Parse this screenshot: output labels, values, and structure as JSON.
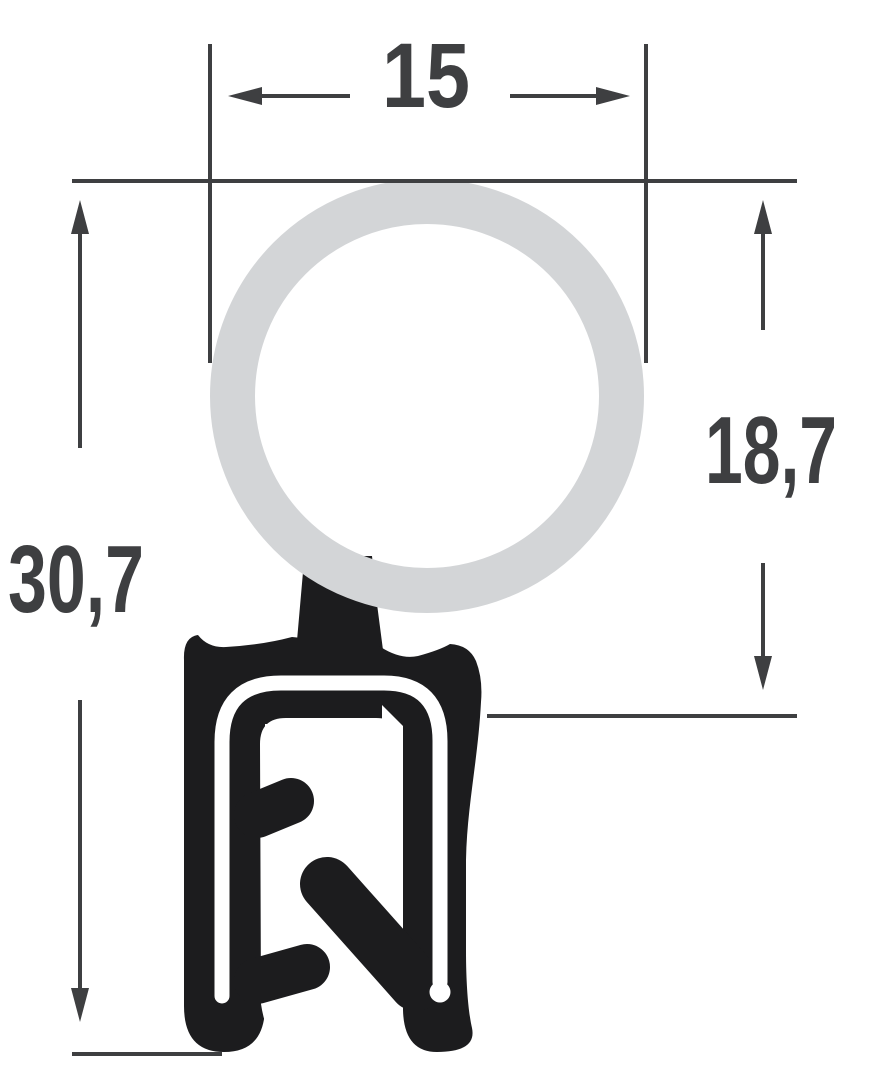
{
  "diagram": {
    "type": "seal-profile-cross-section",
    "labels": {
      "width_top": "15",
      "overall_height": "30,7",
      "bulb_height": "18,7"
    },
    "colors": {
      "profile": "#1c1c1e",
      "bulb": "#d3d5d7",
      "dimension": "#3e3f41",
      "background": "#ffffff"
    }
  }
}
